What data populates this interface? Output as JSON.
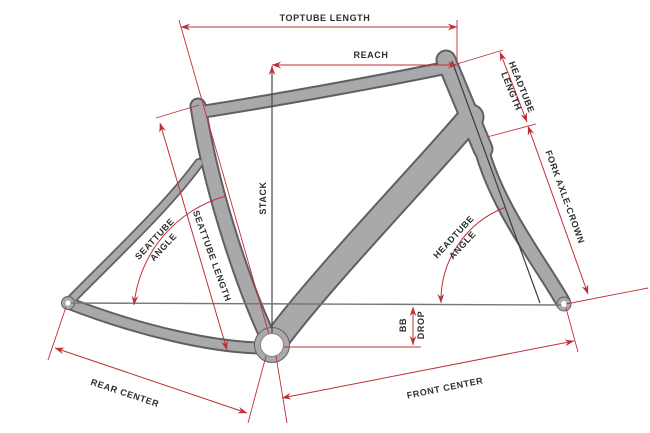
{
  "diagram": {
    "subject": "road-bike-frame-geometry",
    "labels": {
      "toptube_length": "TOPTUBE LENGTH",
      "reach": "REACH",
      "headtube_length": {
        "line1": "HEADTUBE",
        "line2": "LENGTH"
      },
      "fork_axle_crown": "FORK AXLE-CROWN",
      "stack": "STACK",
      "seattube_angle": {
        "line1": "SEATTUBE",
        "line2": "ANGLE"
      },
      "seattube_length": "SEATTUBE LENGTH",
      "headtube_angle": {
        "line1": "HEADTUBE",
        "line2": "ANGLE"
      },
      "bb_drop": {
        "line1": "BB",
        "line2": "DROP"
      },
      "rear_center": "REAR CENTER",
      "front_center": "FRONT CENTER"
    },
    "colors": {
      "dimension_red": "#be3036",
      "frame_gray": "#a9a9ac",
      "frame_outline": "#606063",
      "label_text": "#2e2e30",
      "reference_line": "#77777a",
      "background": "#ffffff"
    }
  }
}
